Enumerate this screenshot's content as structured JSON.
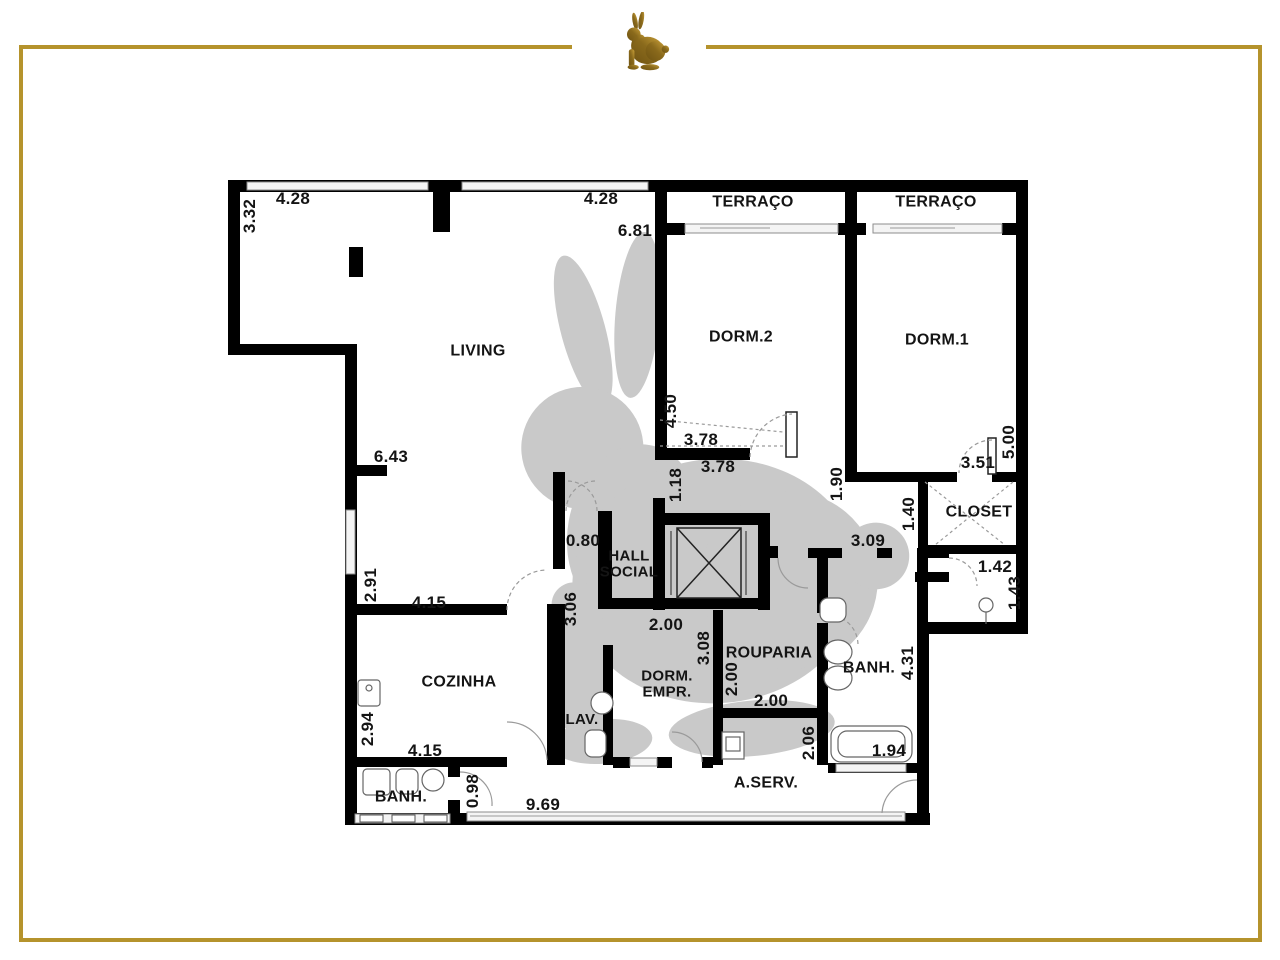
{
  "brand": {
    "logo_icon": "rabbit-icon",
    "watermark_icon": "rabbit-watermark-icon",
    "frame_color": "#b5932c",
    "logo_gold_dark": "#6f5312",
    "logo_gold_light": "#caa13a",
    "watermark_color": "#c9c9c9",
    "wall_color": "#000000"
  },
  "plan": {
    "room_labels": [
      {
        "id": "terraco-1",
        "text": "TERRAÇO",
        "x": 753,
        "y": 203
      },
      {
        "id": "terraco-2",
        "text": "TERRAÇO",
        "x": 936,
        "y": 203
      },
      {
        "id": "living",
        "text": "LIVING",
        "x": 478,
        "y": 352
      },
      {
        "id": "dorm-2",
        "text": "DORM.2",
        "x": 741,
        "y": 338
      },
      {
        "id": "dorm-1",
        "text": "DORM.1",
        "x": 937,
        "y": 341
      },
      {
        "id": "closet",
        "text": "CLOSET",
        "x": 979,
        "y": 513
      },
      {
        "id": "hall-social",
        "text": "HALL\nSOCIAL",
        "x": 629,
        "y": 564,
        "size": 15
      },
      {
        "id": "cozinha",
        "text": "COZINHA",
        "x": 459,
        "y": 683
      },
      {
        "id": "lav",
        "text": "LAV.",
        "x": 582,
        "y": 720,
        "size": 15
      },
      {
        "id": "dorm-empr",
        "text": "DORM.\nEMPR.",
        "x": 667,
        "y": 684,
        "size": 15
      },
      {
        "id": "rouparia",
        "text": "ROUPARIA",
        "x": 769,
        "y": 654
      },
      {
        "id": "banh-suite",
        "text": "BANH.",
        "x": 869,
        "y": 669
      },
      {
        "id": "a-serv",
        "text": "A.SERV.",
        "x": 766,
        "y": 784
      },
      {
        "id": "banh-empr",
        "text": "BANH.",
        "x": 401,
        "y": 798
      }
    ],
    "dimension_labels": [
      {
        "text": "4.28",
        "x": 293,
        "y": 199
      },
      {
        "text": "4.28",
        "x": 601,
        "y": 199
      },
      {
        "text": "6.81",
        "x": 635,
        "y": 231
      },
      {
        "text": "3.32",
        "x": 250,
        "y": 216,
        "vertical": true
      },
      {
        "text": "4.50",
        "x": 671,
        "y": 411,
        "vertical": true
      },
      {
        "text": "3.78",
        "x": 701,
        "y": 440
      },
      {
        "text": "3.78",
        "x": 718,
        "y": 467
      },
      {
        "text": "1.18",
        "x": 676,
        "y": 485,
        "vertical": true
      },
      {
        "text": "1.90",
        "x": 837,
        "y": 484,
        "vertical": true
      },
      {
        "text": "5.00",
        "x": 1009,
        "y": 442,
        "vertical": true
      },
      {
        "text": "3.51",
        "x": 978,
        "y": 463
      },
      {
        "text": "1.40",
        "x": 909,
        "y": 514,
        "vertical": true
      },
      {
        "text": "6.43",
        "x": 391,
        "y": 457
      },
      {
        "text": "0.80",
        "x": 583,
        "y": 541
      },
      {
        "text": "3.09",
        "x": 868,
        "y": 541
      },
      {
        "text": "1.42",
        "x": 995,
        "y": 567
      },
      {
        "text": "1.43",
        "x": 1015,
        "y": 593,
        "vertical": true
      },
      {
        "text": "2.91",
        "x": 371,
        "y": 585,
        "vertical": true
      },
      {
        "text": "4.15",
        "x": 429,
        "y": 603
      },
      {
        "text": "3.06",
        "x": 571,
        "y": 609,
        "vertical": true
      },
      {
        "text": "2.00",
        "x": 666,
        "y": 625
      },
      {
        "text": "3.08",
        "x": 704,
        "y": 648,
        "vertical": true
      },
      {
        "text": "2.00",
        "x": 732,
        "y": 679,
        "vertical": true
      },
      {
        "text": "2.00",
        "x": 771,
        "y": 701
      },
      {
        "text": "4.31",
        "x": 908,
        "y": 663,
        "vertical": true
      },
      {
        "text": "2.94",
        "x": 368,
        "y": 729,
        "vertical": true
      },
      {
        "text": "4.15",
        "x": 425,
        "y": 751
      },
      {
        "text": "1.94",
        "x": 889,
        "y": 751
      },
      {
        "text": "2.06",
        "x": 809,
        "y": 743,
        "vertical": true
      },
      {
        "text": "0.98",
        "x": 473,
        "y": 791,
        "vertical": true
      },
      {
        "text": "9.69",
        "x": 543,
        "y": 805
      }
    ]
  }
}
